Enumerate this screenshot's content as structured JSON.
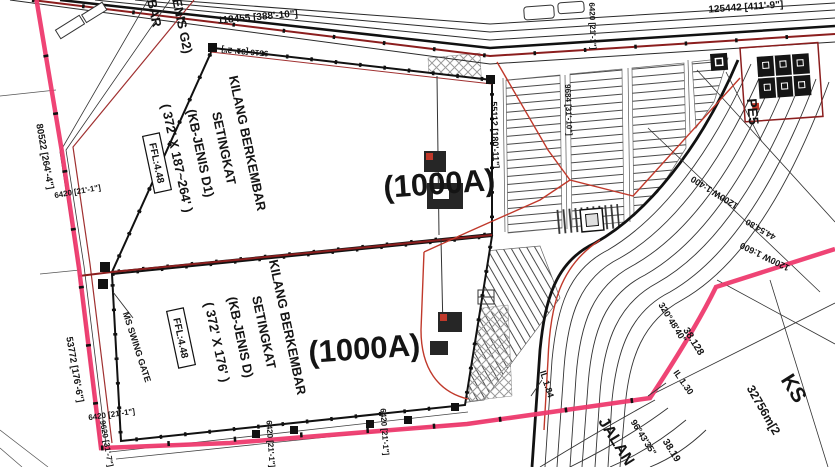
{
  "buildings": {
    "b1": {
      "line1": "KILANG BERKEMBAR",
      "line2": "SETINGKAT",
      "line3": "(KB-JENIS D1)",
      "line4": "( 372' X 187~264' )",
      "ffl": "FFL:4.48",
      "code": "(1000A)"
    },
    "b2": {
      "line1": "KILANG BERKEMBAR",
      "line2": "SETINGKAT",
      "line3": "(KB-JENIS D)",
      "line4": "( 372' X 176' )",
      "ffl": "FFL:4.48",
      "code": "(1000A)"
    },
    "neighbor": {
      "frag1": "BAR",
      "frag2": "ENIS G2)"
    }
  },
  "dimensions": {
    "top_left": "118455 [388'-10\"]",
    "top_right": "125442 [411'-9\"]",
    "upper_inner": "9516 [31'-2\"]",
    "left_upper": "80522 [264'-4\"]",
    "left_lower": "53772 [176'-6\"]",
    "right_inner": "9684 [31'-10\"]",
    "parking_side": "55112 [180'-11\"]",
    "bottom_left": "9620 [31'-7\"]",
    "gate_a": "6420 [21'-1\"]",
    "gate_b": "6420 [21'-1\"]",
    "gate_c": "6420 [21'-1\"]",
    "gate_d": "6420 [21'-1\"]",
    "gate_e": "6420 [21'-1\"]"
  },
  "annotations": {
    "gate": "MS SWING GATE",
    "il_130": "IL 1.30",
    "il_184": "IL 1.84",
    "radius_1": "38.128",
    "radius_2": "38.19",
    "bearing_1": "320°48'40\"",
    "bearing_2": "96°43'35\"",
    "chainage": "44.54.80",
    "drain_1": "1200W 1:400",
    "drain_2": "1200W 1:600"
  },
  "roads": {
    "name": "JALAN",
    "pe5": "PE5"
  },
  "parcels": {
    "ks": "KS",
    "ks_area": "32756m[2"
  },
  "colors": {
    "boundary_pink": "#ee3a6e",
    "dark_red": "#8b1e1e",
    "utility_red": "#c0392b",
    "line_black": "#1a1a1a",
    "hatch_gray": "#999999"
  }
}
